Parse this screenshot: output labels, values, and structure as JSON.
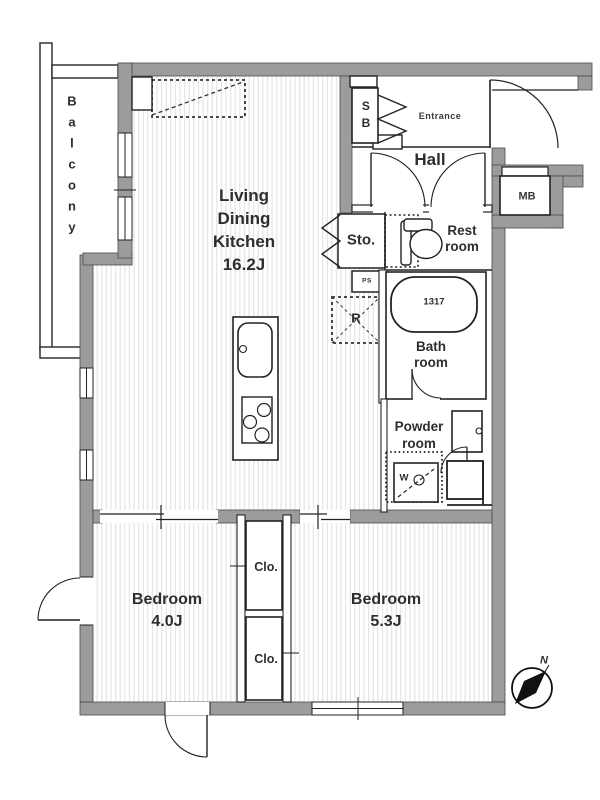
{
  "colors": {
    "wall_fill": "#9c9c9c",
    "line": "#222222",
    "floor_stripe": "#e5e5e5",
    "text": "#2e2e2e",
    "background": "#ffffff"
  },
  "rooms": {
    "balcony": {
      "label": "Balcony"
    },
    "living_dining_kitchen": {
      "label_lines": [
        "Living",
        "Dining",
        "Kitchen"
      ],
      "size": "16.2J"
    },
    "entrance": {
      "label": "Entrance"
    },
    "hall": {
      "label": "Hall"
    },
    "storage": {
      "label": "Sto."
    },
    "rest_room": {
      "label_lines": [
        "Rest",
        "room"
      ]
    },
    "bath_room": {
      "label_lines": [
        "Bath",
        "room"
      ],
      "bathtub_size": "1317"
    },
    "powder_room": {
      "label_lines": [
        "Powder",
        "room"
      ]
    },
    "bedroom_1": {
      "label": "Bedroom",
      "size": "4.0J"
    },
    "bedroom_2": {
      "label": "Bedroom",
      "size": "5.3J"
    },
    "closet_1": {
      "label": "Clo."
    },
    "closet_2": {
      "label": "Clo."
    }
  },
  "fixtures": {
    "shoe_box": "SB",
    "meter_box": "MB",
    "pipe_space": "PS",
    "refrigerator_space": "R",
    "washing_machine": "W",
    "compass_north": "N"
  }
}
